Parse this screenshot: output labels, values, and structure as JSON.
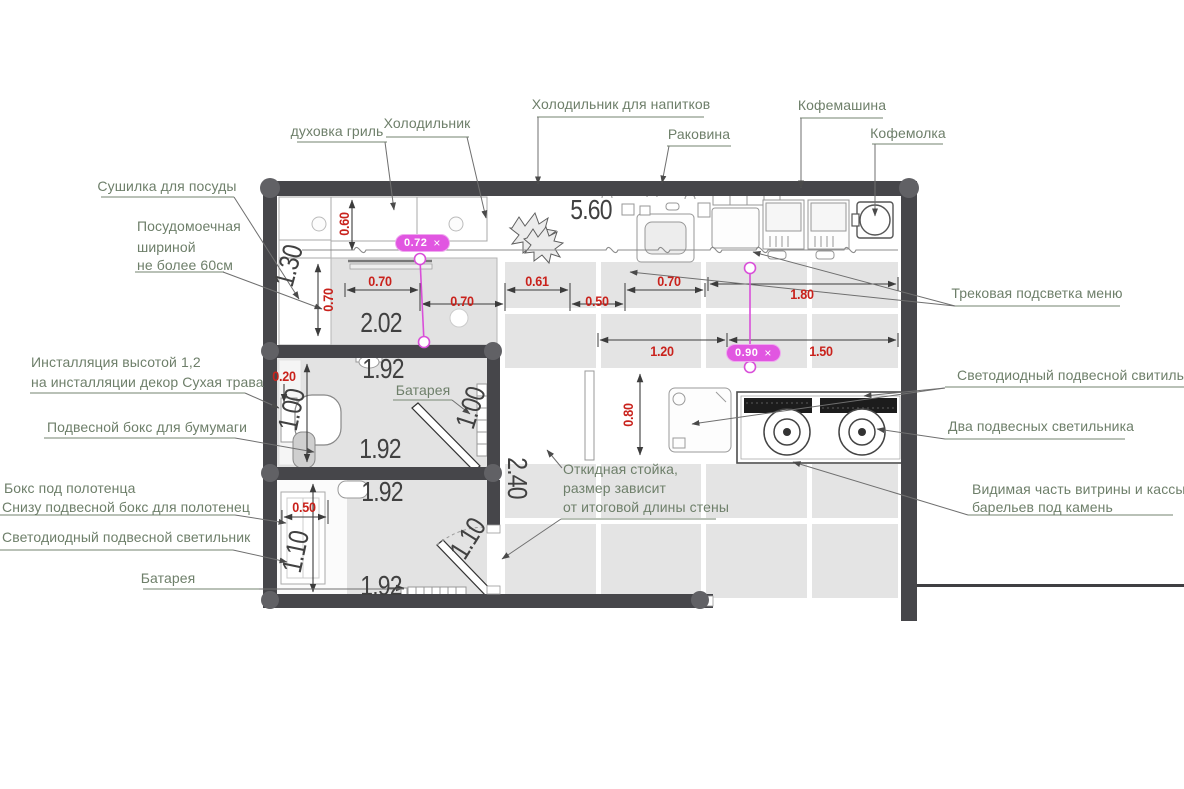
{
  "callouts": {
    "oven": "духовка гриль",
    "fridge": "Холодильник",
    "drinks_fridge": "Холодильник для напитков",
    "sink": "Раковина",
    "coffee_machine": "Кофемашина",
    "coffee_grinder": "Кофемолка",
    "dish_dryer": "Сушилка для посуды",
    "dishwasher_1": "Посудомоечная",
    "dishwasher_2": "шириной",
    "dishwasher_3": "не более 60см",
    "track_light": "Трековая подсветка меню",
    "installation_1": "Инсталляция высотой 1,2",
    "installation_2": "на инсталляции декор Сухая трава",
    "paper_box": "Подвесной бокс для бумумаги",
    "towel_box_1": "Бокс под полотенца",
    "towel_box_2": "Снизу подвесной бокс для полотенец",
    "led_light_left": "Светодиодный подвесной светильник",
    "battery_bath": "Батарея",
    "battery_bottom": "Батарея",
    "led_light_right": "Светодиодный подвесной свитильник",
    "two_lights": "Два подвесных светильника",
    "vitrine_1": "Видимая часть витрины и кассы",
    "vitrine_2": "барельев под камень",
    "fold_counter_1": "Откидная стойка,",
    "fold_counter_2": "размер зависит",
    "fold_counter_3": "от итоговой длины стены"
  },
  "dims_large": {
    "total_width": "5.60",
    "kitchen_counter": "2.02",
    "kitchen_depth": "1.30",
    "bath1_top": "1.92",
    "bath1_bottom": "1.92",
    "bath1_left": "1.00",
    "bath1_right": "1.00",
    "bath2_top": "1.92",
    "bath2_bottom": "1.92",
    "bath2_left": "1.10",
    "bath2_door": "1.10",
    "hall_depth": "2.40"
  },
  "dims_small": {
    "cabinet_depth": "0.60",
    "counter_depth_v": "0.70",
    "seg_1": "0.70",
    "seg_2": "0.70",
    "seg_3": "0.61",
    "seg_4": "0.50",
    "seg_5": "0.70",
    "track_length": "1.80",
    "pass_width": "1.20",
    "vitrine_length": "1.50",
    "register_depth": "0.80",
    "install_offset": "0.20",
    "shower_width": "0.50"
  },
  "measure_tags": {
    "tag1": {
      "value": "0.72",
      "close": "×"
    },
    "tag2": {
      "value": "0.90",
      "close": "×"
    }
  },
  "colors": {
    "wall": "#46464a",
    "tile": "#e4e4e4",
    "counter": "#e2e2e2",
    "label": "#6e7f6a",
    "dim_red": "#c9221c",
    "dim_dark": "#414141",
    "magenta": "#d94fd9",
    "magenta_bg": "#e156e1",
    "leader": "#6f6f6f",
    "underline": "#8f9c8c"
  }
}
